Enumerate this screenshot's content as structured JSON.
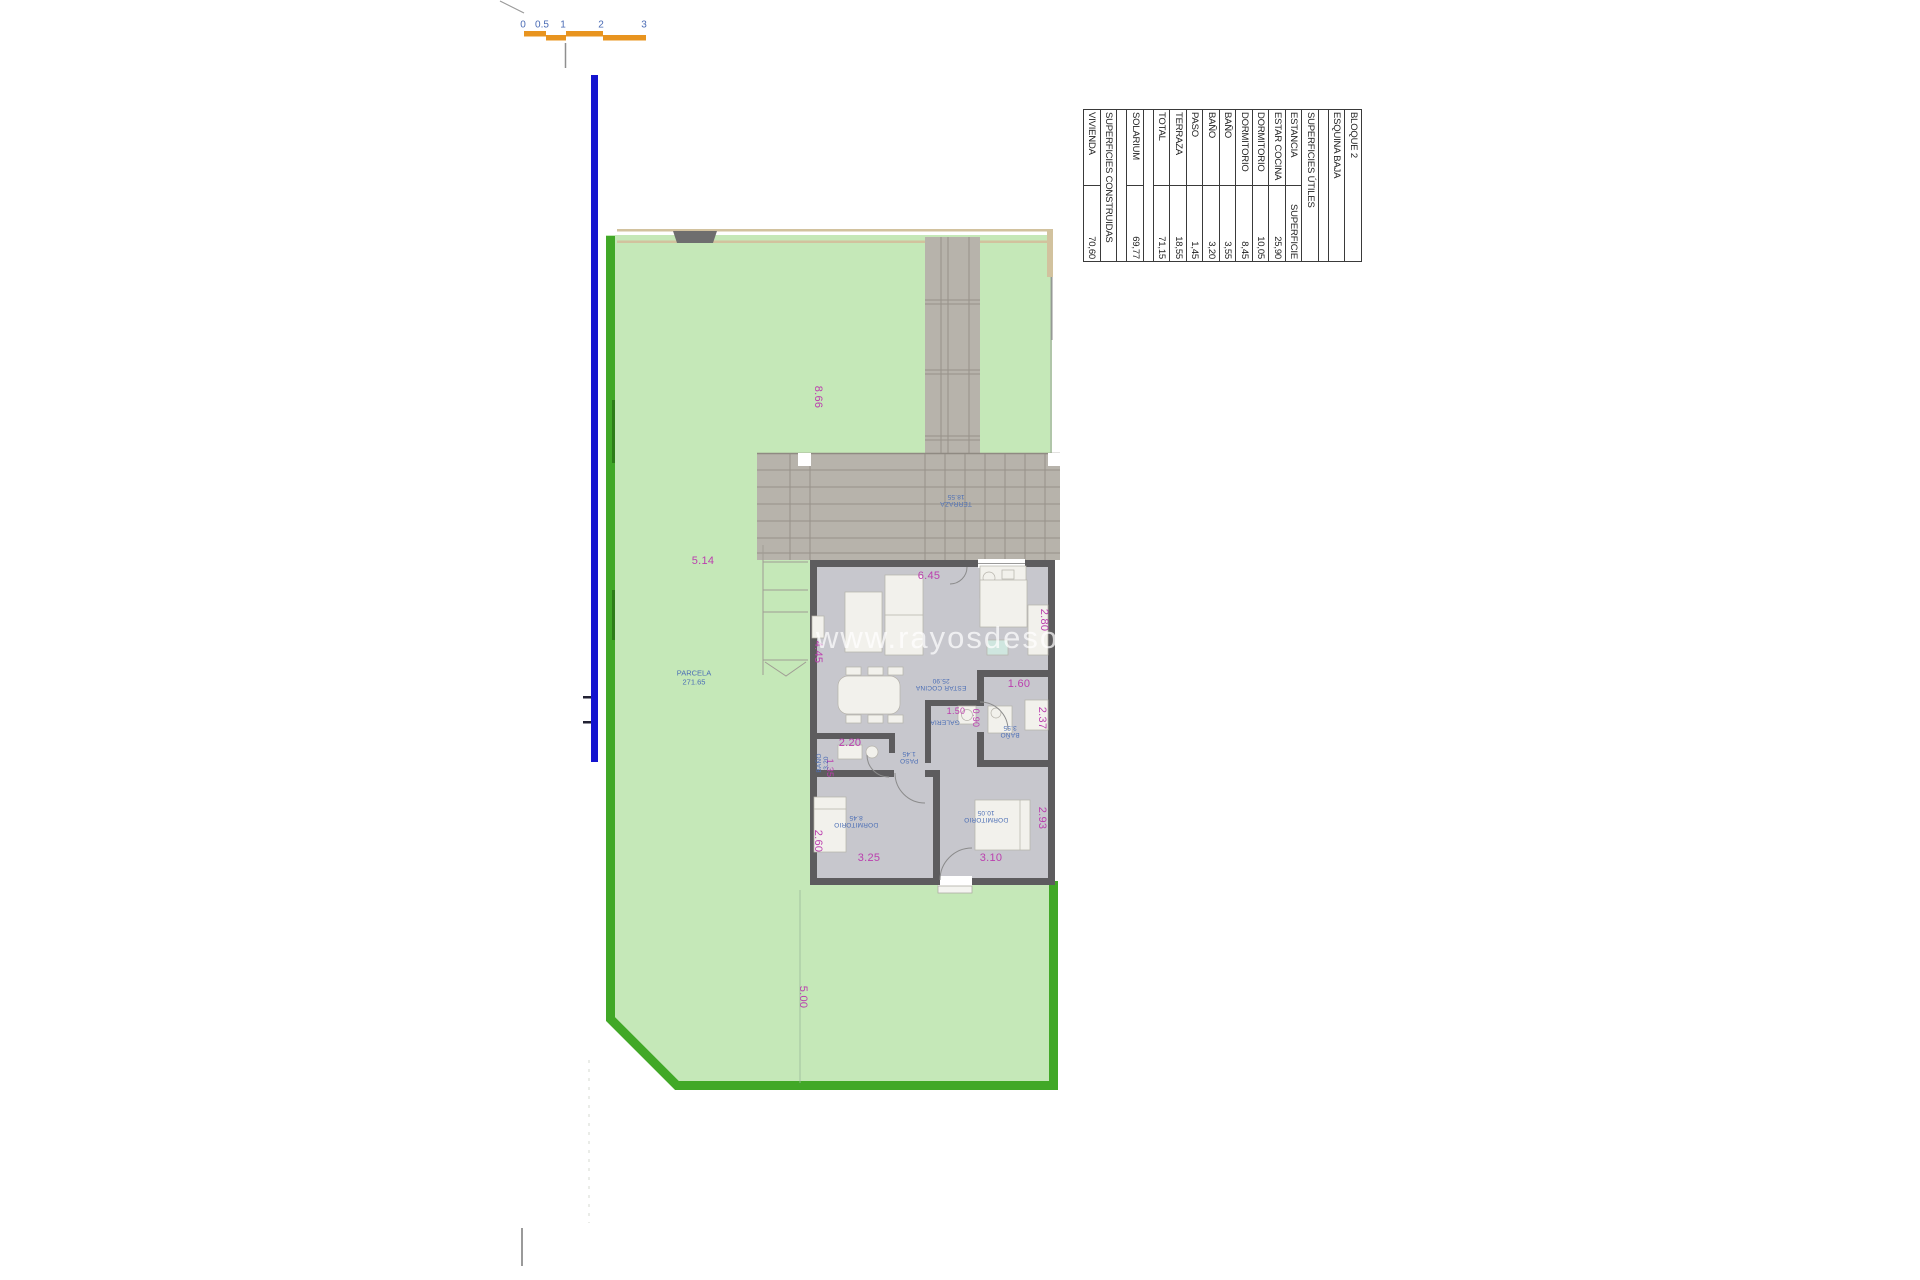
{
  "scalebar": {
    "labels": [
      "0",
      "0.5",
      "1",
      "2",
      "3"
    ],
    "bar_color": "#e8941f",
    "label_color": "#4a6bb5"
  },
  "watermark": {
    "text": "www.rayosdesol.c"
  },
  "parcel": {
    "label_line1": "PARCELA",
    "label_line2": "271.65",
    "fill_color": "#c5e8b8",
    "border_color": "#41a827"
  },
  "plan_colors": {
    "blue_boundary": "#1414cf",
    "paving_gray": "#b7b3ab",
    "floor_gray": "#c7c7cd",
    "wall_gray": "#5d5c5e",
    "tan_line": "#d2c29e",
    "dimension_magenta": "#bb3fae",
    "label_blue": "#4a6db5"
  },
  "rooms": {
    "estar": {
      "line1": "ESTAR COCINA",
      "line2": "25.90"
    },
    "galeria": {
      "line1": "GALERIA"
    },
    "paso": {
      "line1": "PASO",
      "line2": "1.45"
    },
    "banyo355": {
      "line1": "BAÑO",
      "line2": "3.55"
    },
    "banyo320": {
      "line1": "BAÑO",
      "line2": "3.20"
    },
    "dorm845": {
      "line1": "DORMITORIO",
      "line2": "8.45"
    },
    "dorm1005": {
      "line1": "DORMITORIO",
      "line2": "10.05"
    },
    "terraza": {
      "line1": "TERRAZA",
      "line2": "18.55"
    }
  },
  "dimensions": {
    "d866": "8.66",
    "d514": "5.14",
    "d500": "5.00",
    "d645": "6.45",
    "d280": "2.80",
    "d445": "4.45",
    "d160": "1.60",
    "d150": "1.50",
    "d090": "0.90",
    "d237": "2.37",
    "d220": "2.20",
    "d135": "1.35",
    "d260": "2.60",
    "d293": "2.93",
    "d325": "3.25",
    "d310": "3.10"
  },
  "table": {
    "rows": [
      {
        "label": "BLOQUE 2"
      },
      {
        "label": "ESQUINA BAJA"
      },
      {
        "label": "",
        "spacer": true
      },
      {
        "label": "SUPERFICIES ÚTILES"
      },
      {
        "label": "ESTANCIA",
        "value": "SUPERFICIE"
      },
      {
        "label": "ESTAR COCINA",
        "value": "25,90"
      },
      {
        "label": "DORMITORIO",
        "value": "10,05"
      },
      {
        "label": "DORMITORIO",
        "value": "8,45"
      },
      {
        "label": "BAÑO",
        "value": "3,55"
      },
      {
        "label": "BAÑO",
        "value": "3,20"
      },
      {
        "label": "PASO",
        "value": "1,45"
      },
      {
        "label": "TERRAZA",
        "value": "18,55"
      },
      {
        "label": "TOTAL",
        "value": "71,15"
      },
      {
        "label": "",
        "spacer": true
      },
      {
        "label": "SOLARIUM",
        "value": "69,77"
      },
      {
        "label": "",
        "spacer": true
      },
      {
        "label": "SUPERFICIES CONSTRUIDAS"
      },
      {
        "label": "VIVIENDA",
        "value": "70,60"
      }
    ]
  }
}
